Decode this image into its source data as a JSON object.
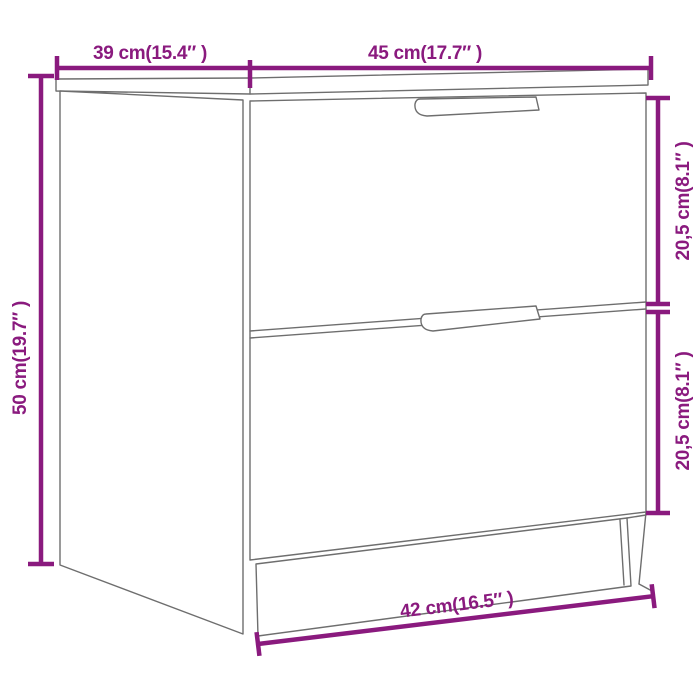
{
  "colors": {
    "dimension": "#8a1a7e",
    "outline": "#6e6e6e",
    "background": "#ffffff"
  },
  "diagram": {
    "type": "furniture-dimension-drawing",
    "dimensions": {
      "top_left": "39 cm(15.4″ )",
      "top_right": "45 cm(17.7″ )",
      "side": "50 cm(19.7″ )",
      "right_upper": "20,5 cm(8.1″ )",
      "right_lower": "20,5 cm(8.1″ )",
      "bottom": "42 cm(16.5″ )"
    }
  }
}
